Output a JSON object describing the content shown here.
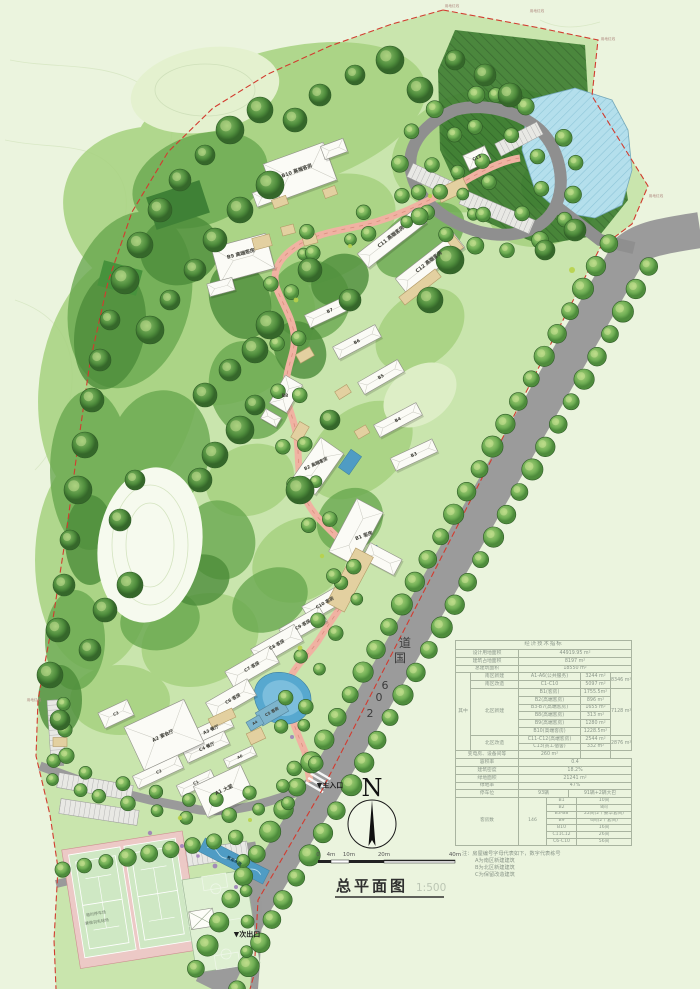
{
  "title_block": {
    "title": "总平面图",
    "scale": "1:500"
  },
  "north": {
    "letter": "N"
  },
  "scalebar": {
    "t0": "0",
    "t1": "4m",
    "t2": "10m",
    "t3": "20m",
    "t4": "40m"
  },
  "road": {
    "name": "206国道",
    "c1": "道",
    "c2": "国",
    "c3": "6",
    "c4": "0",
    "c5": "2"
  },
  "entrances": {
    "main": "▼主入口",
    "secondary": "▼次出口"
  },
  "site_labels": {
    "water_feature": "景观水池",
    "temp_parking_1": "临时停车场",
    "temp_parking_2": "兼做羽毛球场",
    "boundary": "用地红线"
  },
  "buildings": [
    {
      "label": "B10 高端客房"
    },
    {
      "label": "B9 高端客房"
    },
    {
      "label": "C11 高端客房"
    },
    {
      "label": "C12 高端客房"
    },
    {
      "label": "C13"
    },
    {
      "label": "B7"
    },
    {
      "label": "B6"
    },
    {
      "label": "B5"
    },
    {
      "label": "B4"
    },
    {
      "label": "B3"
    },
    {
      "label": "B8"
    },
    {
      "label": "B2 高端客房"
    },
    {
      "label": "B1 客房"
    },
    {
      "label": "C10 客房"
    },
    {
      "label": "C9 客房"
    },
    {
      "label": "C8 客房"
    },
    {
      "label": "C7 客房"
    },
    {
      "label": "C6 客房"
    },
    {
      "label": "C5 客房"
    },
    {
      "label": "A4"
    },
    {
      "label": "A3 餐厅"
    },
    {
      "label": "C4 餐厅"
    },
    {
      "label": "A6"
    },
    {
      "label": "A2 宴会厅"
    },
    {
      "label": "C3"
    },
    {
      "label": "C2"
    },
    {
      "label": "C1"
    },
    {
      "label": "A1 大堂"
    }
  ],
  "table": {
    "title": "经济技术指标",
    "r_land": [
      "设计用地面积",
      "44919.95 m²"
    ],
    "r_footprint": [
      "建筑占地面积",
      "8197  m²"
    ],
    "r_gfa": [
      "总建筑面积",
      "18550  m²"
    ],
    "among": "其中",
    "south_new": [
      "南区新建",
      "A1-A6(公共服务)",
      "3244 m²",
      "8346 m²"
    ],
    "south_ren": [
      "南区改造",
      "C1-C10",
      "5097 m²"
    ],
    "north_new_label": "北区新建",
    "north_new_rows": [
      [
        "B1(客房)",
        "1755.5m²"
      ],
      [
        "B2(高端客房)",
        "896  m²"
      ],
      [
        "B3-B7(高端客房)",
        "1655  m²"
      ],
      [
        "B8(高端客房)",
        "313  m²"
      ],
      [
        "B9(高端客房)",
        "1280  m²"
      ],
      [
        "B10(高端客房)",
        "1228.5m²"
      ]
    ],
    "north_new_subtotal": "7128 m²",
    "north_ren_label": "北区改造",
    "north_ren_rows": [
      [
        "C11-C12(高端客房)",
        "2544 m²"
      ],
      [
        "C13(员工宿舍)",
        "332  m²"
      ]
    ],
    "north_ren_subtotal": "2876 m²",
    "r_equip": [
      "变电房、设备间等",
      "260  m²"
    ],
    "r_far": [
      "容积率",
      "0.4"
    ],
    "r_density": [
      "建筑密度",
      "18.2%"
    ],
    "r_green": [
      "绿地面积",
      "21241    m²"
    ],
    "r_greenrate": [
      "绿地率",
      "47%"
    ],
    "r_parking": [
      "停车位",
      "93辆",
      "91辆+2辆大巴"
    ],
    "rooms_label": "客房数",
    "rooms_total": "146",
    "rooms_rows": [
      [
        "B1",
        "10间"
      ],
      [
        "B2",
        "8间"
      ],
      [
        "B3-B8",
        "22间(2个豪华套间)"
      ],
      [
        "B9",
        "4间(2个套间)"
      ],
      [
        "B10",
        "16间"
      ],
      [
        "C11C12",
        "26间"
      ],
      [
        "C6-C10",
        "56间"
      ]
    ]
  },
  "notes": {
    "l1": "注：房屋编号字母代表如下，数字代表栋号",
    "l2": "A为南区新建建筑",
    "l3": "B为北区新建建筑",
    "l4": "C为保留改造建筑"
  },
  "colors": {
    "boundary": "#d23b2f",
    "road": "#9a9a9a",
    "water": "#8fcbe0",
    "path": "#f0b2a2"
  }
}
